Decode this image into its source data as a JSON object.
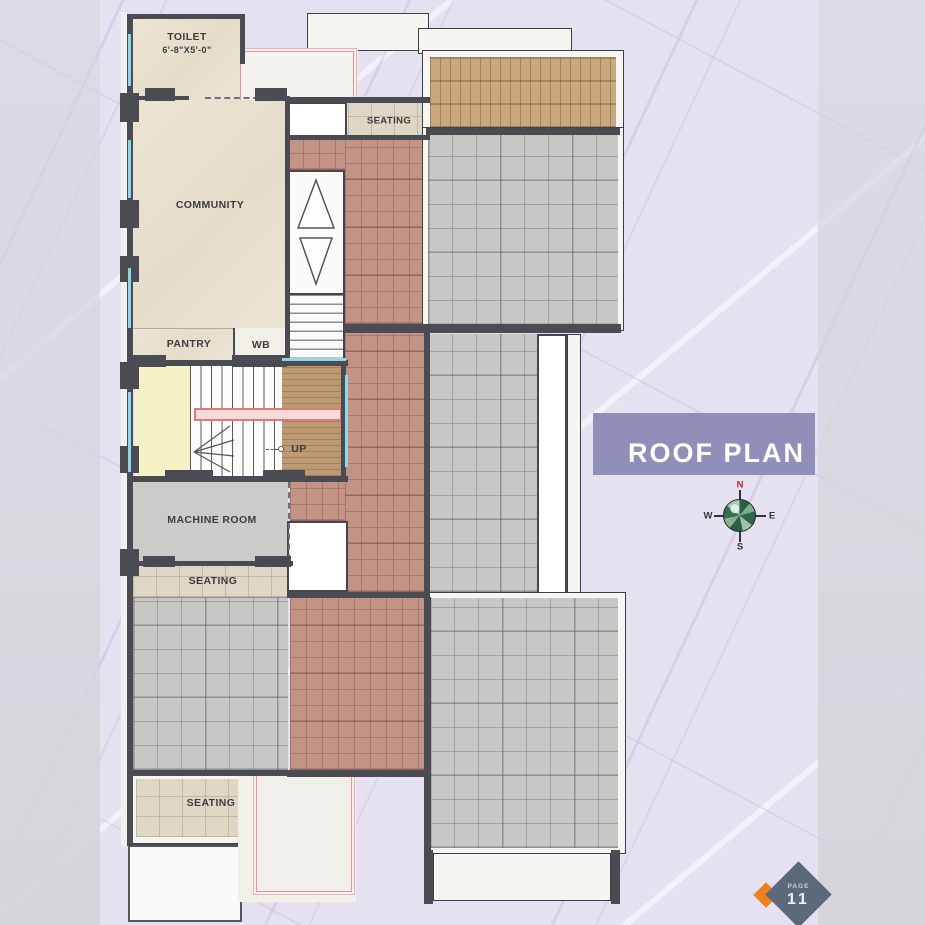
{
  "plan": {
    "title": "ROOF PLAN",
    "rooms": {
      "toilet": {
        "name": "TOILET",
        "size": "6'-8\"X5'-0\""
      },
      "community": {
        "name": "COMMUNITY"
      },
      "pantry": {
        "name": "PANTRY"
      },
      "wb": {
        "name": "WB"
      },
      "machine_room": {
        "name": "MACHINE ROOM"
      },
      "seating_top": "SEATING",
      "seating_middle": "SEATING",
      "seating_bottom": "SEATING",
      "stair_direction": "UP"
    },
    "compass": {
      "n": "N",
      "e": "E",
      "s": "S",
      "w": "W"
    },
    "page": {
      "label": "PAGE",
      "number": "11"
    },
    "colors": {
      "background": "#e6e1f1",
      "banner": "#908fb9",
      "wall": "#4b4b54",
      "terracotta_tile": "#c39486",
      "roof_tile_gray": "#c8c7c5",
      "marble_beige": "#ece4d4",
      "seating_tile": "#ded7c6",
      "wood_pergola": "#c9a87d",
      "lawn_green": "#478334",
      "stair_landing_yellow": "#f6f1c6",
      "accent_pink": "#e8939c",
      "accent_cyan": "#8fd6e8",
      "north_red": "#cc2020",
      "page_diamond": "#5a6a7a",
      "page_accent_orange": "#ee8020"
    }
  }
}
